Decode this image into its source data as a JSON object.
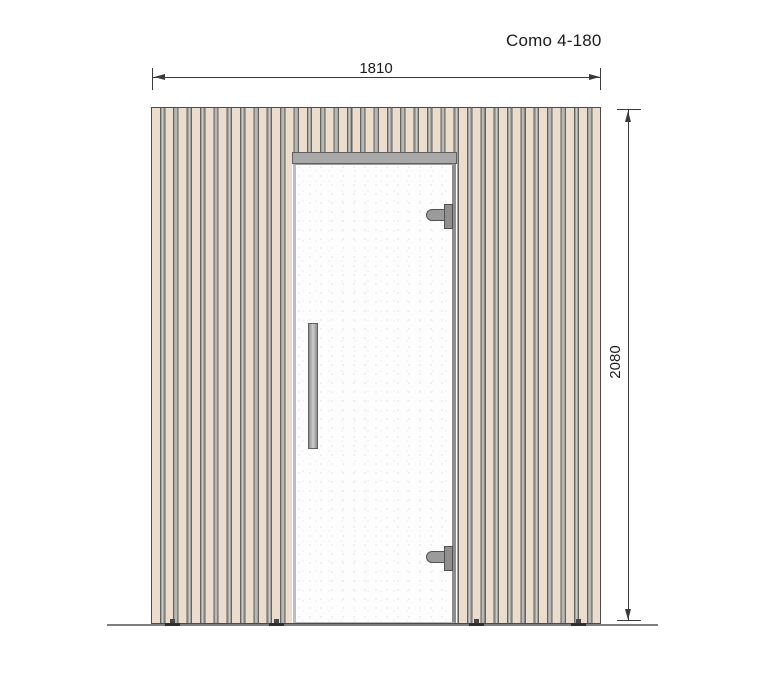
{
  "title": "Como 4-180",
  "dimensions": {
    "width_label": "1810",
    "height_label": "2080"
  },
  "drawing": {
    "view": "front elevation of slatted sauna cabin with glass door",
    "colors": {
      "slat_beige": "#ebdccb",
      "slat_gap_gray": "#a3a3a3",
      "frame_gray": "#a9a9a9",
      "glass_white": "#fdfdfd",
      "dimension_line": "#3a3a3a",
      "ground_line": "#7f7f7f"
    }
  }
}
